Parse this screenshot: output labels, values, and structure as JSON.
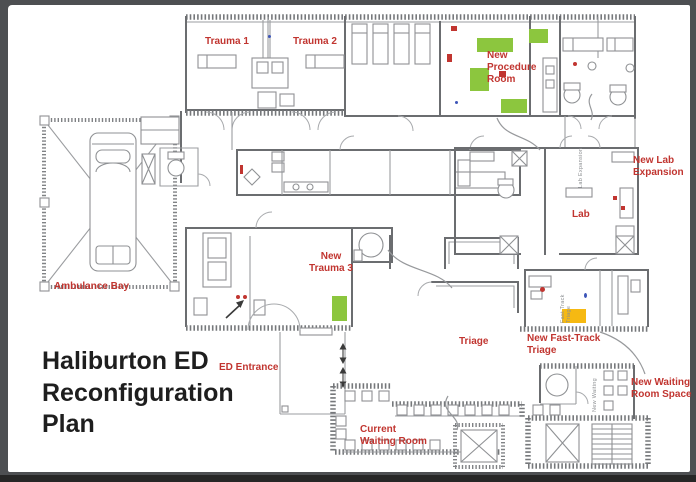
{
  "title": {
    "full": "Haliburton ED Reconfiguration Plan",
    "line1": "Haliburton ED",
    "line2": "Reconfiguration",
    "line3": "Plan"
  },
  "labels": {
    "trauma_1": "Trauma 1",
    "trauma_2": "Trauma 2",
    "new_procedure_room": "New Procedure Room",
    "new_lab_expansion": "New Lab Expansion",
    "lab": "Lab",
    "ambulance_bay": "Ambulance Bay",
    "new_trauma_3": "New Trauma 3",
    "ed_entrance": "ED Entrance",
    "triage": "Triage",
    "new_fast_track_triage": "New Fast-Track Triage",
    "current_waiting_room": "Current Waiting Room",
    "new_waiting_room_space": "New Waiting Room Space"
  },
  "plan_texts": {
    "lab_expansion_vertical": "Lab Expansion",
    "fast_track_vertical": "Fast Track Triage",
    "new_waiting_vertical": "New Waiting"
  },
  "colors": {
    "frame": "#4d4f52",
    "page": "#ffffff",
    "label-red": "#c13530",
    "title-black": "#1e1e1e",
    "highlight-green": "#8cc63e",
    "highlight-yellow": "#f6b912",
    "wall": "#6b6d70",
    "wall-light": "#9b9da0"
  }
}
